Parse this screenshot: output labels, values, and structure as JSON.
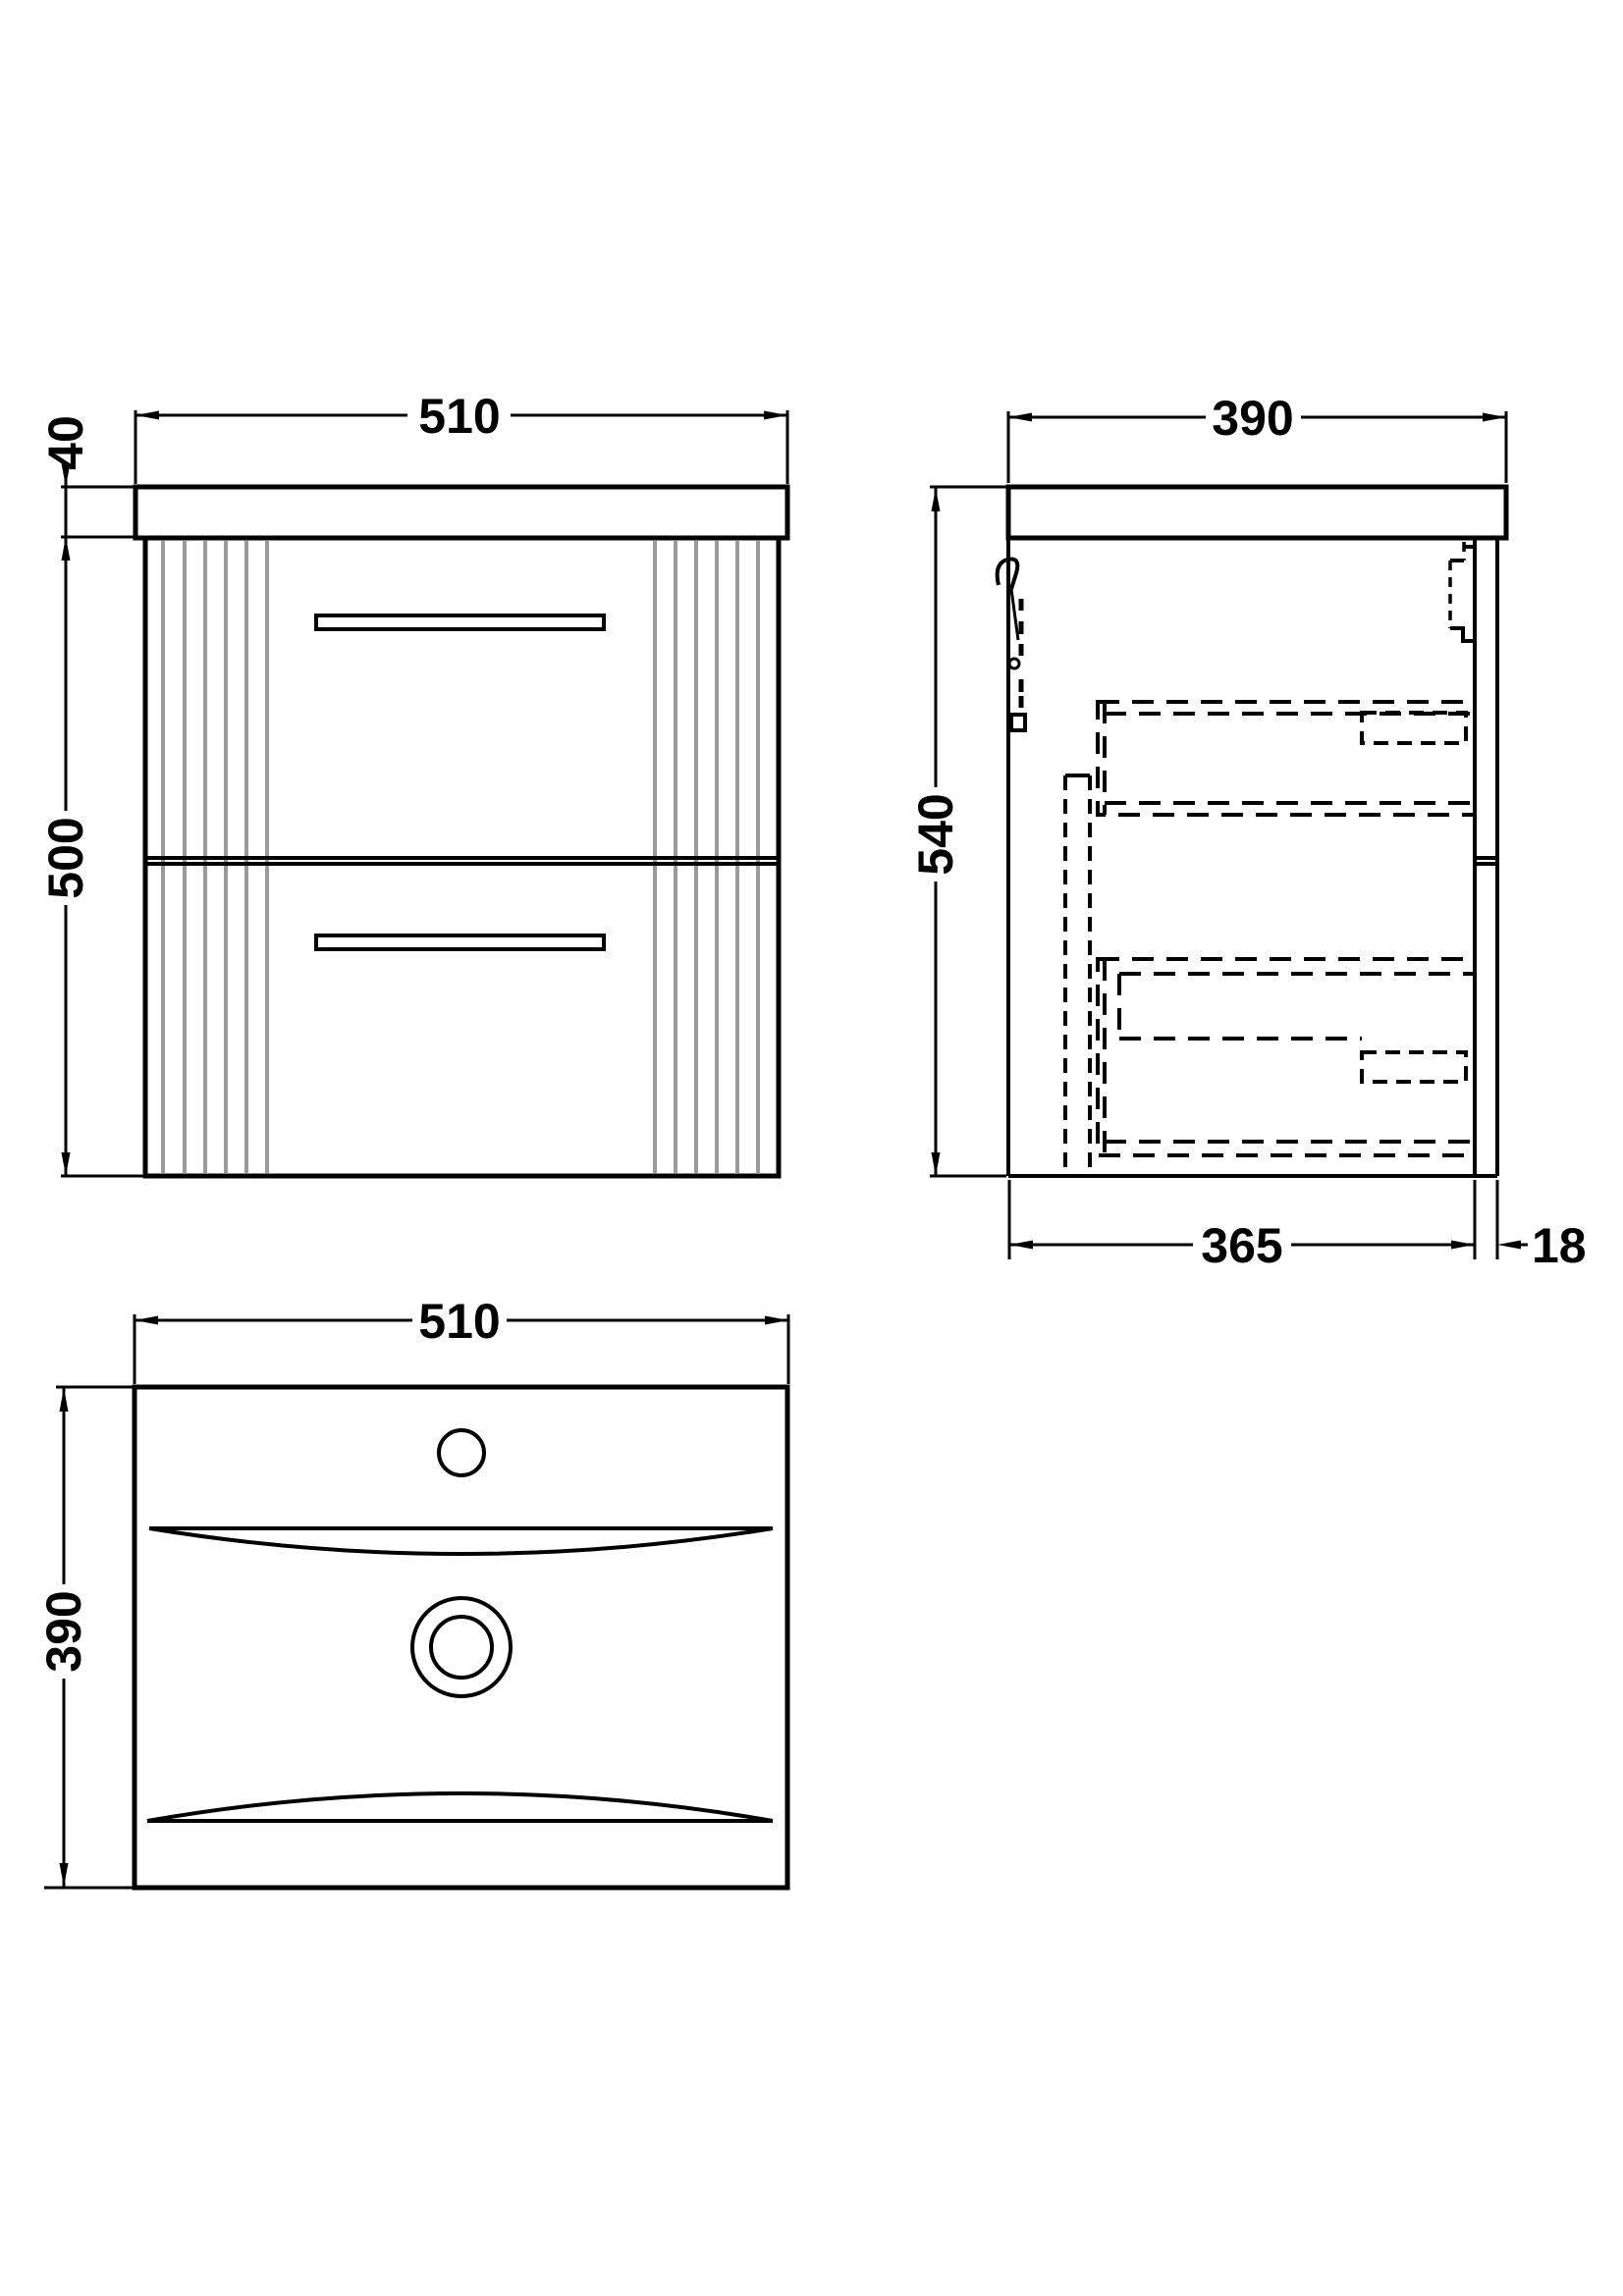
{
  "drawing": {
    "type": "technical-drawing",
    "subject": "wall-hung vanity unit with basin, 2 drawers",
    "colors": {
      "background": "#ffffff",
      "line": "#000000",
      "flute": "#9a9a9a"
    },
    "views": {
      "front_elevation": {
        "labels": {
          "width": "510",
          "countertop_thickness": "40",
          "cabinet_height": "500"
        }
      },
      "side_elevation": {
        "labels": {
          "depth": "390",
          "overall_height": "540",
          "internal_depth": "365",
          "back_panel_thickness": "18"
        }
      },
      "basin_plan": {
        "labels": {
          "width": "510",
          "depth": "390"
        }
      }
    }
  }
}
